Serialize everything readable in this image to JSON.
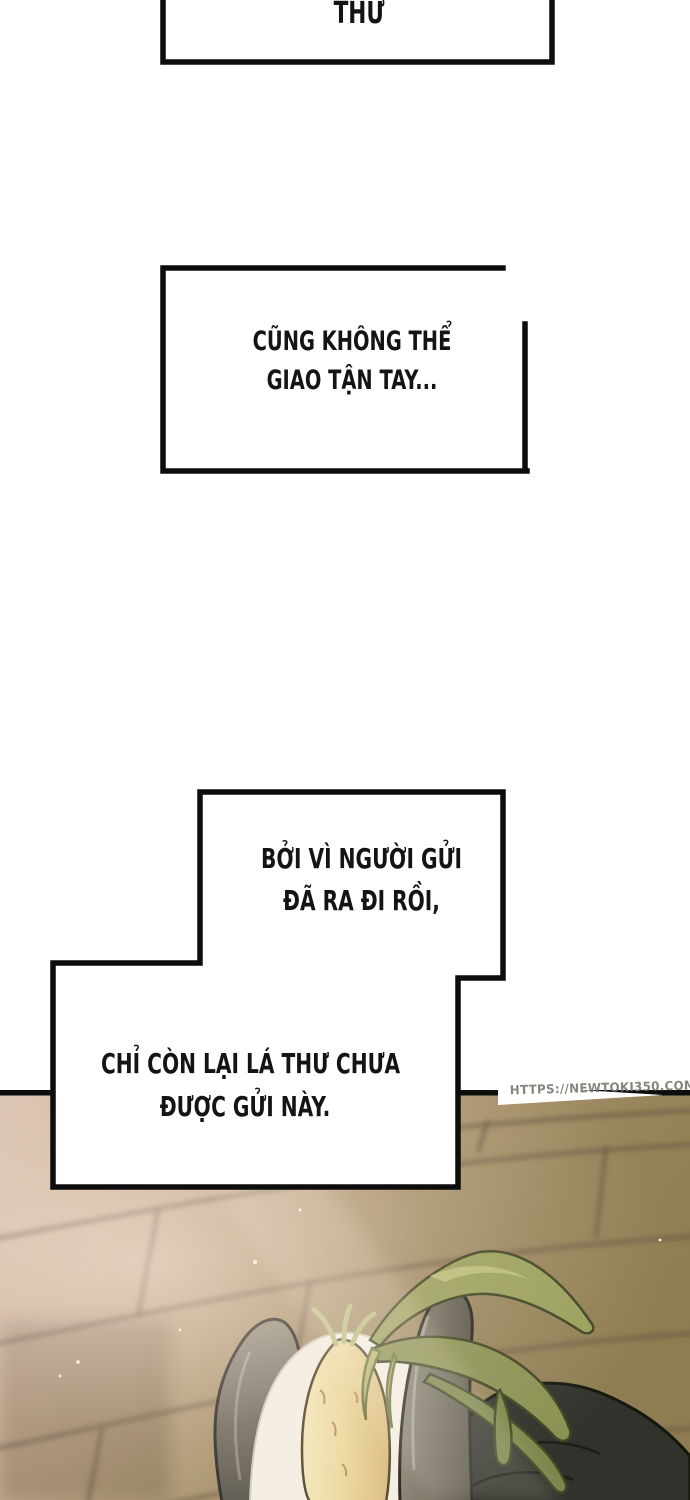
{
  "bubbles": [
    {
      "id": "narration-box-1",
      "lines": [
        "THƯ"
      ]
    },
    {
      "id": "narration-box-2",
      "lines": [
        "CŨNG KHÔNG THỂ",
        "GIAO TẬN TAY..."
      ]
    },
    {
      "id": "narration-box-3",
      "lines": [
        "BỞI VÌ NGƯỜI GỬI",
        "ĐÃ RA ĐI RỒI,"
      ]
    },
    {
      "id": "narration-box-4",
      "lines": [
        "CHỈ CÒN LẠI LÁ THƯ CHƯA",
        "ĐƯỢC GỬI NÀY."
      ]
    }
  ],
  "watermark": {
    "text": "HTTPS://NEWTOKI350.COM"
  },
  "artwork": {
    "elements": [
      "wooden-floor",
      "gloved-thumb",
      "gloved-finger",
      "white-radish",
      "radish-leaves",
      "white-cloth-wrap",
      "dark-coat",
      "dust-specks"
    ],
    "colors": {
      "page_background": "#ffffff",
      "bubble_border": "#0d0d0d",
      "text": "#141414",
      "floor_light": "#d9c0ad",
      "floor_olive": "#8e7c52",
      "plank_seam": "#6e5846",
      "radish": "#ecd9a0",
      "leaves": "#8b9152",
      "glove": "#6b675a",
      "coat": "#30332b",
      "watermark_text": "#78756a"
    }
  }
}
